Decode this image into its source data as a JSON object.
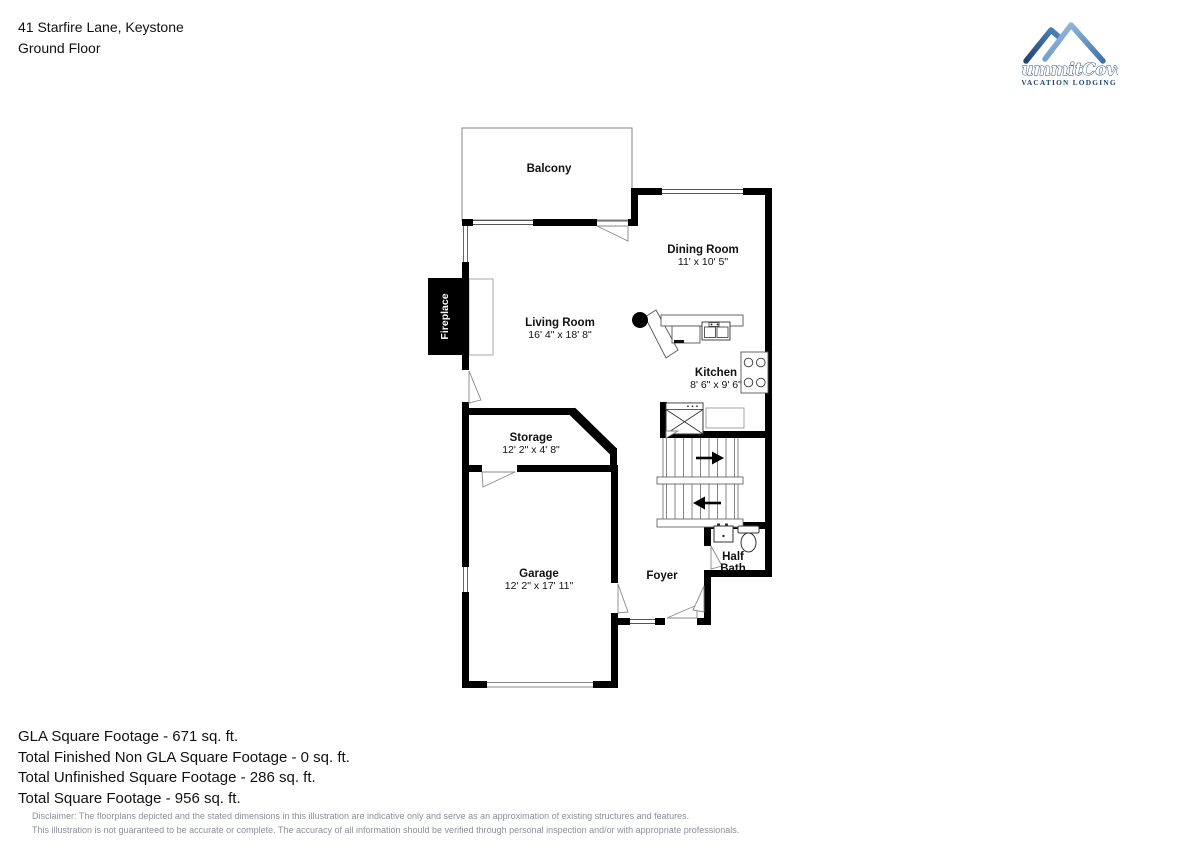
{
  "header": {
    "address": "41 Starfire Lane, Keystone",
    "floor": "Ground Floor"
  },
  "logo": {
    "brand": "SummitCove",
    "tagline": "VACATION LODGING"
  },
  "rooms": {
    "balcony": {
      "name": "Balcony"
    },
    "dining_room": {
      "name": "Dining Room",
      "dims": "11' x 10' 5\""
    },
    "living_room": {
      "name": "Living Room",
      "dims": "16' 4\" x 18' 8\""
    },
    "kitchen": {
      "name": "Kitchen",
      "dims": "8' 6\" x 9' 6\""
    },
    "storage": {
      "name": "Storage",
      "dims": "12' 2\" x 4' 8\""
    },
    "garage": {
      "name": "Garage",
      "dims": "12' 2\" x 17' 11\""
    },
    "foyer": {
      "name": "Foyer"
    },
    "half_bath": {
      "line1": "Half",
      "line2": "Bath"
    },
    "fireplace": {
      "name": "Fireplace"
    }
  },
  "footer": {
    "gla": "GLA Square Footage - 671 sq. ft.",
    "non_gla": "Total Finished Non GLA Square Footage - 0 sq. ft.",
    "unfinished": "Total Unfinished Square Footage - 286 sq. ft.",
    "total": "Total Square Footage - 956 sq. ft.",
    "disclaimer_1": "Disclaimer: The floorplans depicted and the stated dimensions in this illustration are indicative only and serve as an approximation of existing structures and features.",
    "disclaimer_2": "This illustration is not guaranteed to be accurate or complete. The accuracy of all information should be verified through personal inspection and/or with appropriate professionals."
  },
  "colors": {
    "wall": "#000000",
    "thin_line": "#777777",
    "logo_blue_dark": "#2c5c94",
    "logo_blue_light": "#8fb8e4",
    "logo_text": "#23456e",
    "disclaimer_gray": "#8d909a"
  }
}
